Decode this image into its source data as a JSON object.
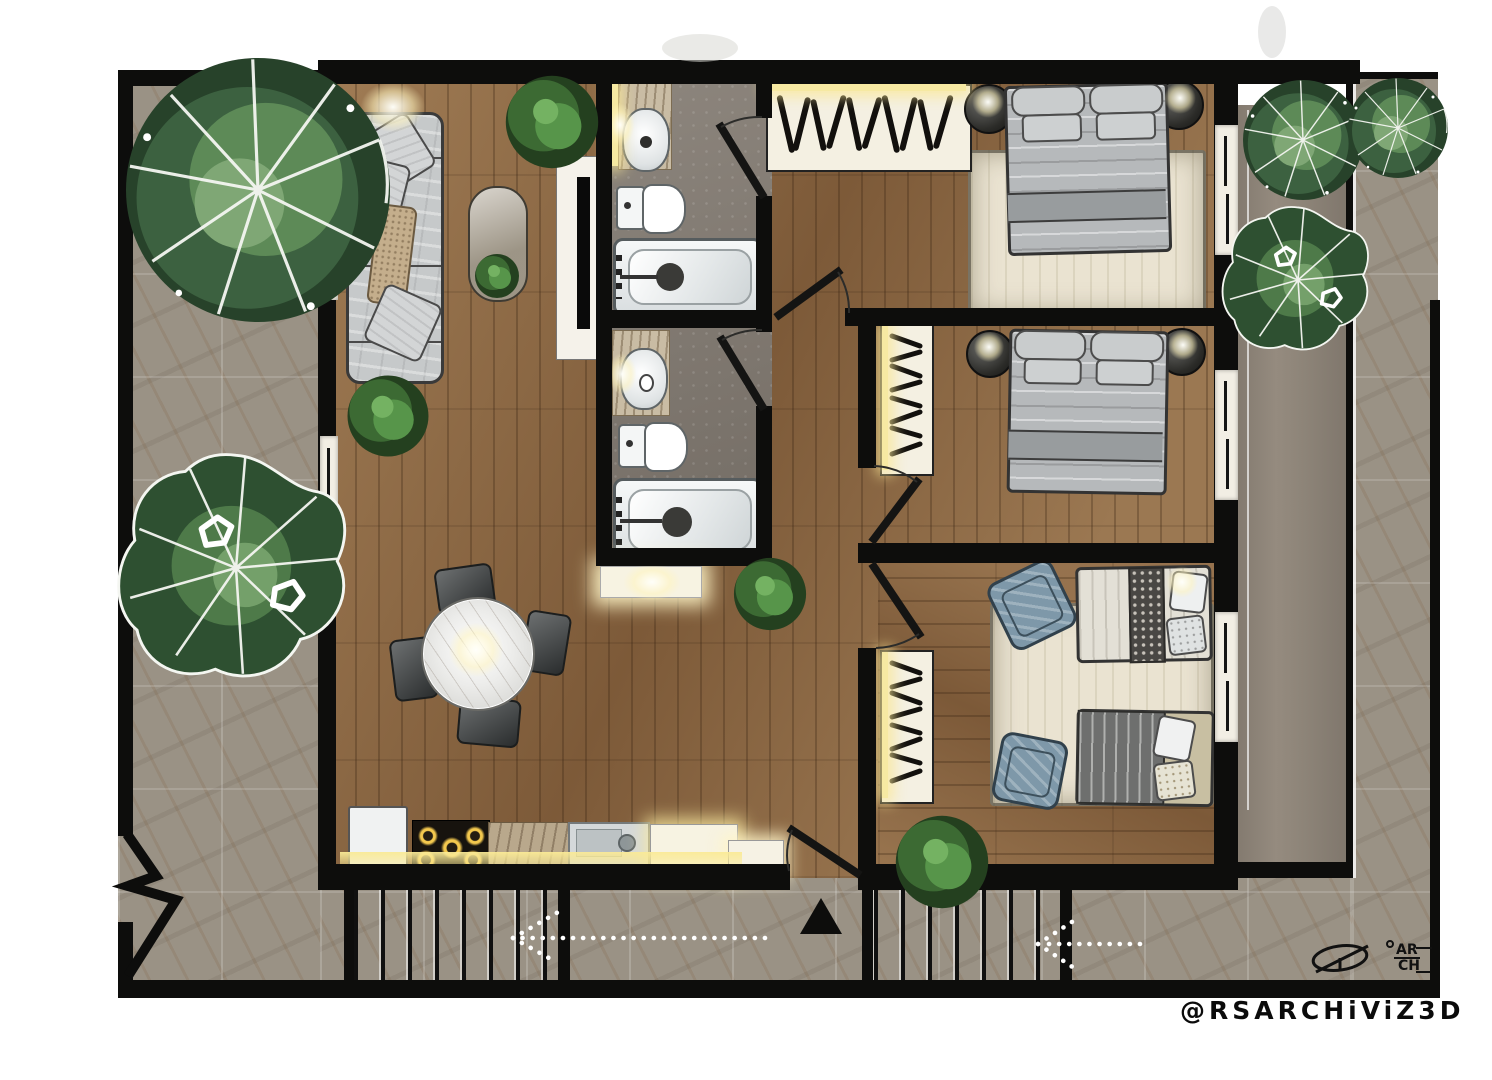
{
  "watermark": {
    "handle": "@RSARCHiViZ3D"
  },
  "signature": {
    "initial": "R",
    "top": "AR",
    "bottom": "CH"
  },
  "palette": {
    "wall": "#0d0d0c",
    "wood_floor": "#8d6944",
    "stone_tile": "#9a9285",
    "balcony_concrete": "#8a8175",
    "bath_floor": "#837b72",
    "rug_cream": "#eae3d1",
    "sofa_gray": "#c6c9ca",
    "bed_gray": "#b6b9bb",
    "armchair_blue": "#7e98a9",
    "marble": "#c7b89e",
    "warm_light": "#f6e9a2",
    "foliage_dark": "#2c4a2e",
    "foliage_light": "#7fa375",
    "white": "#ffffff"
  },
  "legend": {
    "drawing_type": "apartment floor plan, top view render",
    "rooms": [
      {
        "name": "living-room",
        "furniture": [
          "sofa",
          "throw-pillow",
          "oval-rug",
          "floor-plant",
          "tv-console",
          "ceiling-light"
        ]
      },
      {
        "name": "dining-area",
        "furniture": [
          "round-marble-table",
          "chair",
          "chair",
          "chair",
          "chair",
          "pendant-light"
        ]
      },
      {
        "name": "kitchen",
        "furniture": [
          "fridge",
          "gas-stove",
          "marble-counter",
          "sink",
          "lit-counter"
        ]
      },
      {
        "name": "bathroom-1",
        "furniture": [
          "vanity-sink",
          "toilet",
          "bathtub"
        ]
      },
      {
        "name": "bathroom-2",
        "furniture": [
          "vanity-sink",
          "toilet",
          "bathtub"
        ]
      },
      {
        "name": "hallway",
        "furniture": [
          "lit-console",
          "plant",
          "entry-cabinet"
        ]
      },
      {
        "name": "bedroom-1",
        "furniture": [
          "open-wardrobe",
          "double-bed",
          "nightstand",
          "nightstand",
          "area-rug",
          "window"
        ]
      },
      {
        "name": "bedroom-2",
        "furniture": [
          "open-wardrobe",
          "double-bed",
          "nightstand",
          "nightstand",
          "window"
        ]
      },
      {
        "name": "bedroom-3",
        "furniture": [
          "open-wardrobe",
          "single-bed",
          "single-bed",
          "armchair",
          "armchair",
          "area-rug",
          "window"
        ]
      },
      {
        "name": "balcony",
        "furniture": [
          "tree",
          "tree"
        ]
      },
      {
        "name": "patio",
        "furniture": [
          "tree",
          "tree",
          "bush"
        ]
      },
      {
        "name": "exterior",
        "furniture": [
          "staircase",
          "staircase",
          "direction-arrow",
          "direction-arrow",
          "entry-triangle-marker",
          "wall-break-symbol"
        ]
      }
    ]
  }
}
